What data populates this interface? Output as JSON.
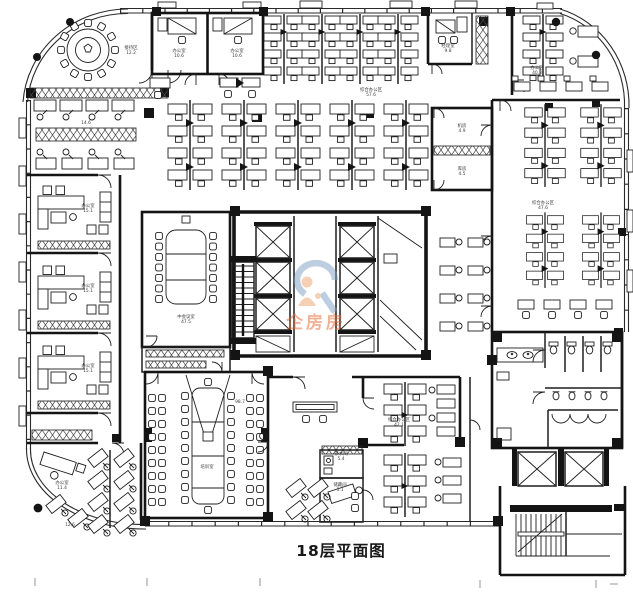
{
  "document": {
    "title": "18层平面图",
    "type": "楼层平面图"
  },
  "watermark": {
    "text": "企房房",
    "text_color": "#e4662e",
    "swirl_color": "#7d9fc4",
    "figure_color": "#efa26d",
    "opacity": "0.5"
  },
  "style": {
    "line_color": "#1f1f1f",
    "wall_color": "#141414",
    "background": "#ffffff",
    "label_color": "#3c3c3c",
    "glass_color": "#2a2a2a",
    "tick_color": "#8a8a8a"
  },
  "labels": [
    {
      "x": 131,
      "y": 49,
      "lines": [
        "接待区",
        "12.2"
      ]
    },
    {
      "x": 179,
      "y": 52,
      "lines": [
        "办公室",
        "10.6"
      ]
    },
    {
      "x": 237,
      "y": 52,
      "lines": [
        "办公室",
        "10.6"
      ]
    },
    {
      "x": 448,
      "y": 47,
      "lines": [
        "经理室",
        "9.8"
      ]
    },
    {
      "x": 371,
      "y": 91,
      "lines": [
        "综合办公区",
        "57.6"
      ]
    },
    {
      "x": 537,
      "y": 69,
      "lines": [
        "办公区",
        "40.3"
      ]
    },
    {
      "x": 462,
      "y": 127,
      "lines": [
        "机房",
        "4.9"
      ]
    },
    {
      "x": 462,
      "y": 170,
      "lines": [
        "库房",
        "4.5"
      ]
    },
    {
      "x": 543,
      "y": 204,
      "lines": [
        "综合办公区",
        "47.6"
      ]
    },
    {
      "x": 86,
      "y": 124,
      "lines": [
        "14.6"
      ]
    },
    {
      "x": 88,
      "y": 207,
      "lines": [
        "办公室",
        "15.1"
      ]
    },
    {
      "x": 88,
      "y": 287,
      "lines": [
        "办公室",
        "15.1"
      ]
    },
    {
      "x": 88,
      "y": 367,
      "lines": [
        "办公室",
        "15.1"
      ]
    },
    {
      "x": 186,
      "y": 318,
      "lines": [
        "中会议室",
        "47.5"
      ]
    },
    {
      "x": 240,
      "y": 403,
      "lines": [
        "98.7"
      ]
    },
    {
      "x": 207,
      "y": 468,
      "lines": [
        "培训室"
      ]
    },
    {
      "x": 399,
      "y": 421,
      "lines": [
        "综合办公区",
        "42.1"
      ]
    },
    {
      "x": 341,
      "y": 455,
      "lines": [
        "茶水间",
        "5.4"
      ]
    },
    {
      "x": 340,
      "y": 486,
      "lines": [
        "储藏间",
        "5.1"
      ]
    },
    {
      "x": 62,
      "y": 484,
      "lines": [
        "办公室",
        "11.4"
      ]
    },
    {
      "x": 70,
      "y": 526,
      "lines": [
        "12.6"
      ]
    }
  ]
}
